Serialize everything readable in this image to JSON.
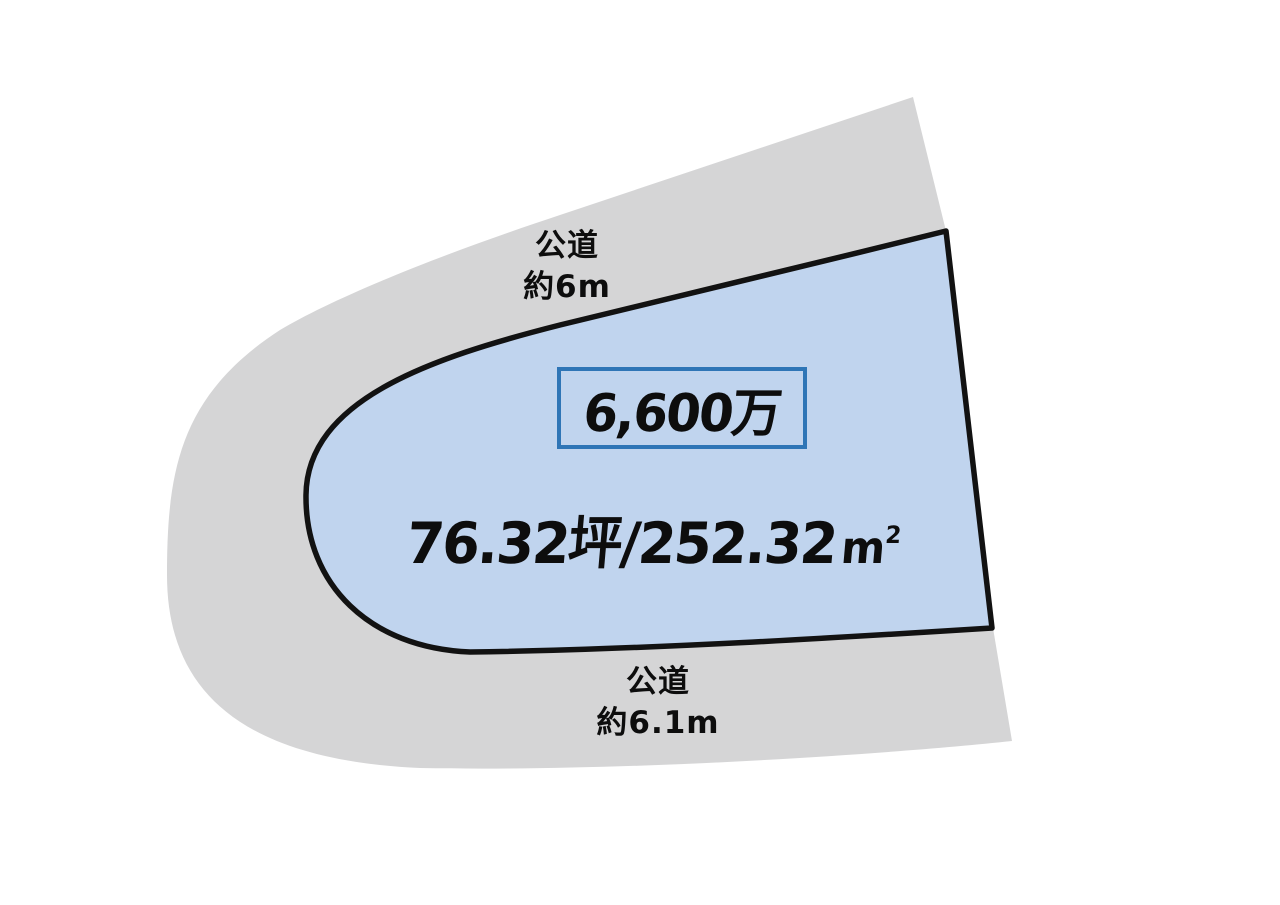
{
  "diagram": {
    "description": "land-plot-price-diagram",
    "colors": {
      "background": "#ffffff",
      "road_fill": "#d5d5d6",
      "parcel_fill": "#c0d4ee",
      "parcel_outline": "#121212",
      "price_box_border": "#2e75b6",
      "text": "#0d0d0d"
    },
    "top_road": {
      "name": "公道",
      "width": "約6m"
    },
    "bottom_road": {
      "name": "公道",
      "width": "約6.1m"
    },
    "price": {
      "label": "6,600万"
    },
    "area": {
      "main": "76.32坪/252.32",
      "unit": "m",
      "sup": "2"
    }
  }
}
